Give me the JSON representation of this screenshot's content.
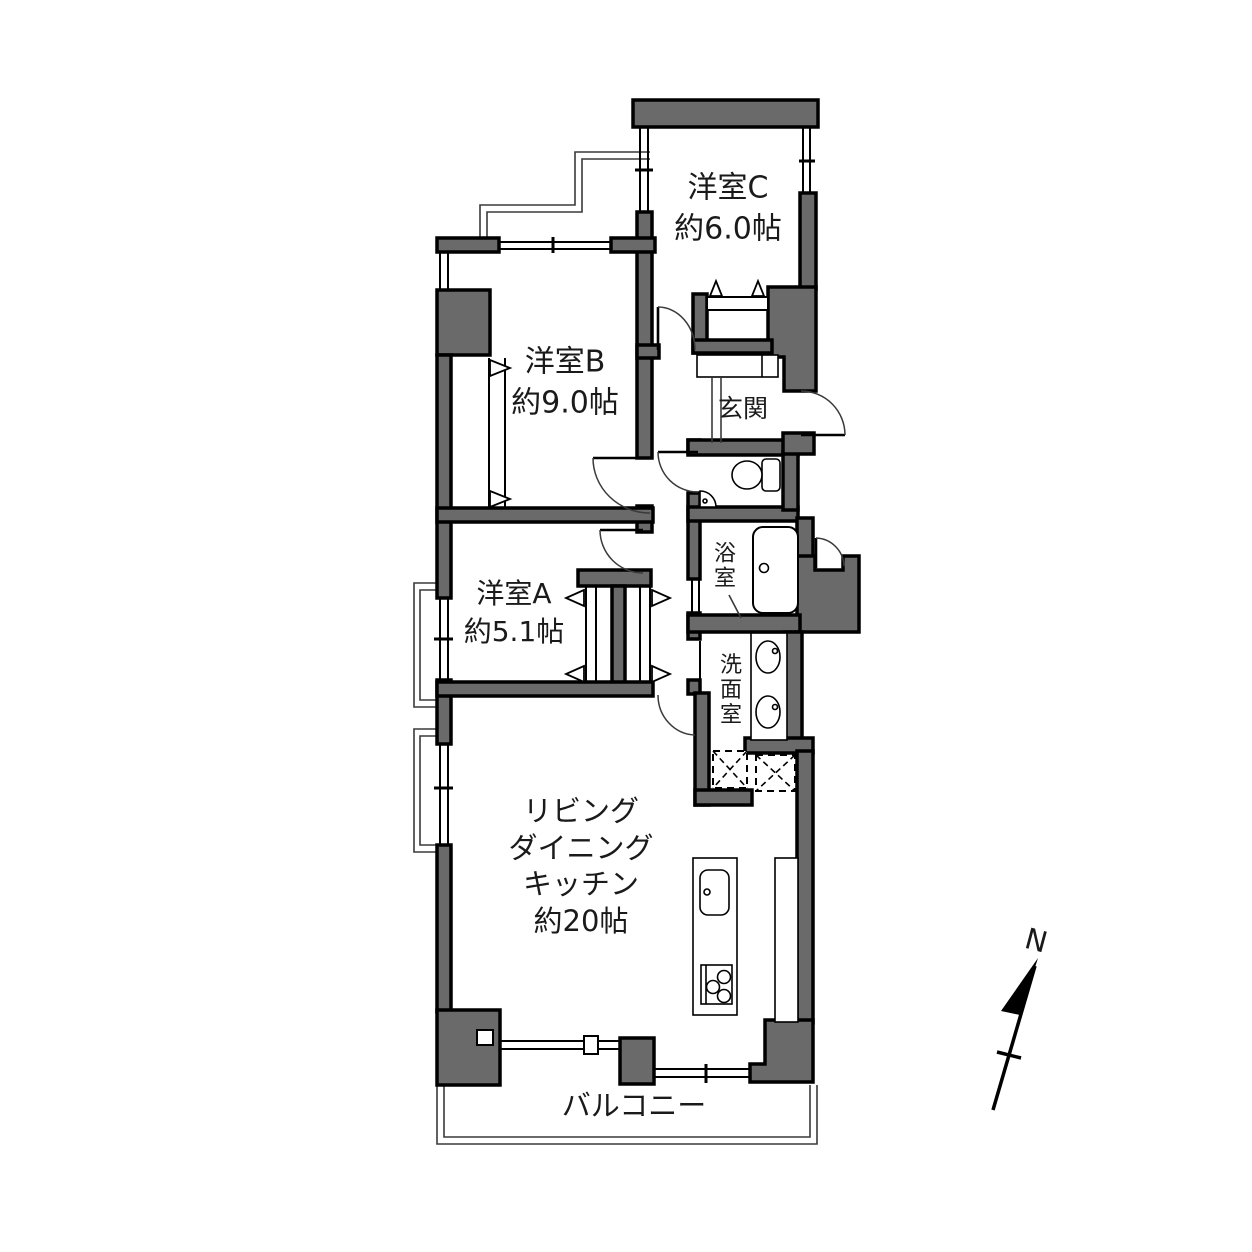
{
  "floor_plan": {
    "rooms": {
      "room_c": {
        "name": "洋室C",
        "size": "約6.0帖"
      },
      "room_b": {
        "name": "洋室B",
        "size": "約9.0帖"
      },
      "room_a": {
        "name": "洋室A",
        "size": "約5.1帖"
      },
      "ldk": {
        "name_line1": "リビング",
        "name_line2": "ダイニング",
        "name_line3": "キッチン",
        "size": "約20帖"
      },
      "entrance": {
        "name": "玄関"
      },
      "bathroom": {
        "name": "浴室"
      },
      "washroom": {
        "name": "洗面室"
      },
      "balcony": {
        "name": "バルコニー"
      }
    },
    "compass": {
      "north_label": "N"
    },
    "colors": {
      "wall_fill": "#6a6a6a",
      "line": "#000000",
      "background": "#ffffff"
    }
  }
}
